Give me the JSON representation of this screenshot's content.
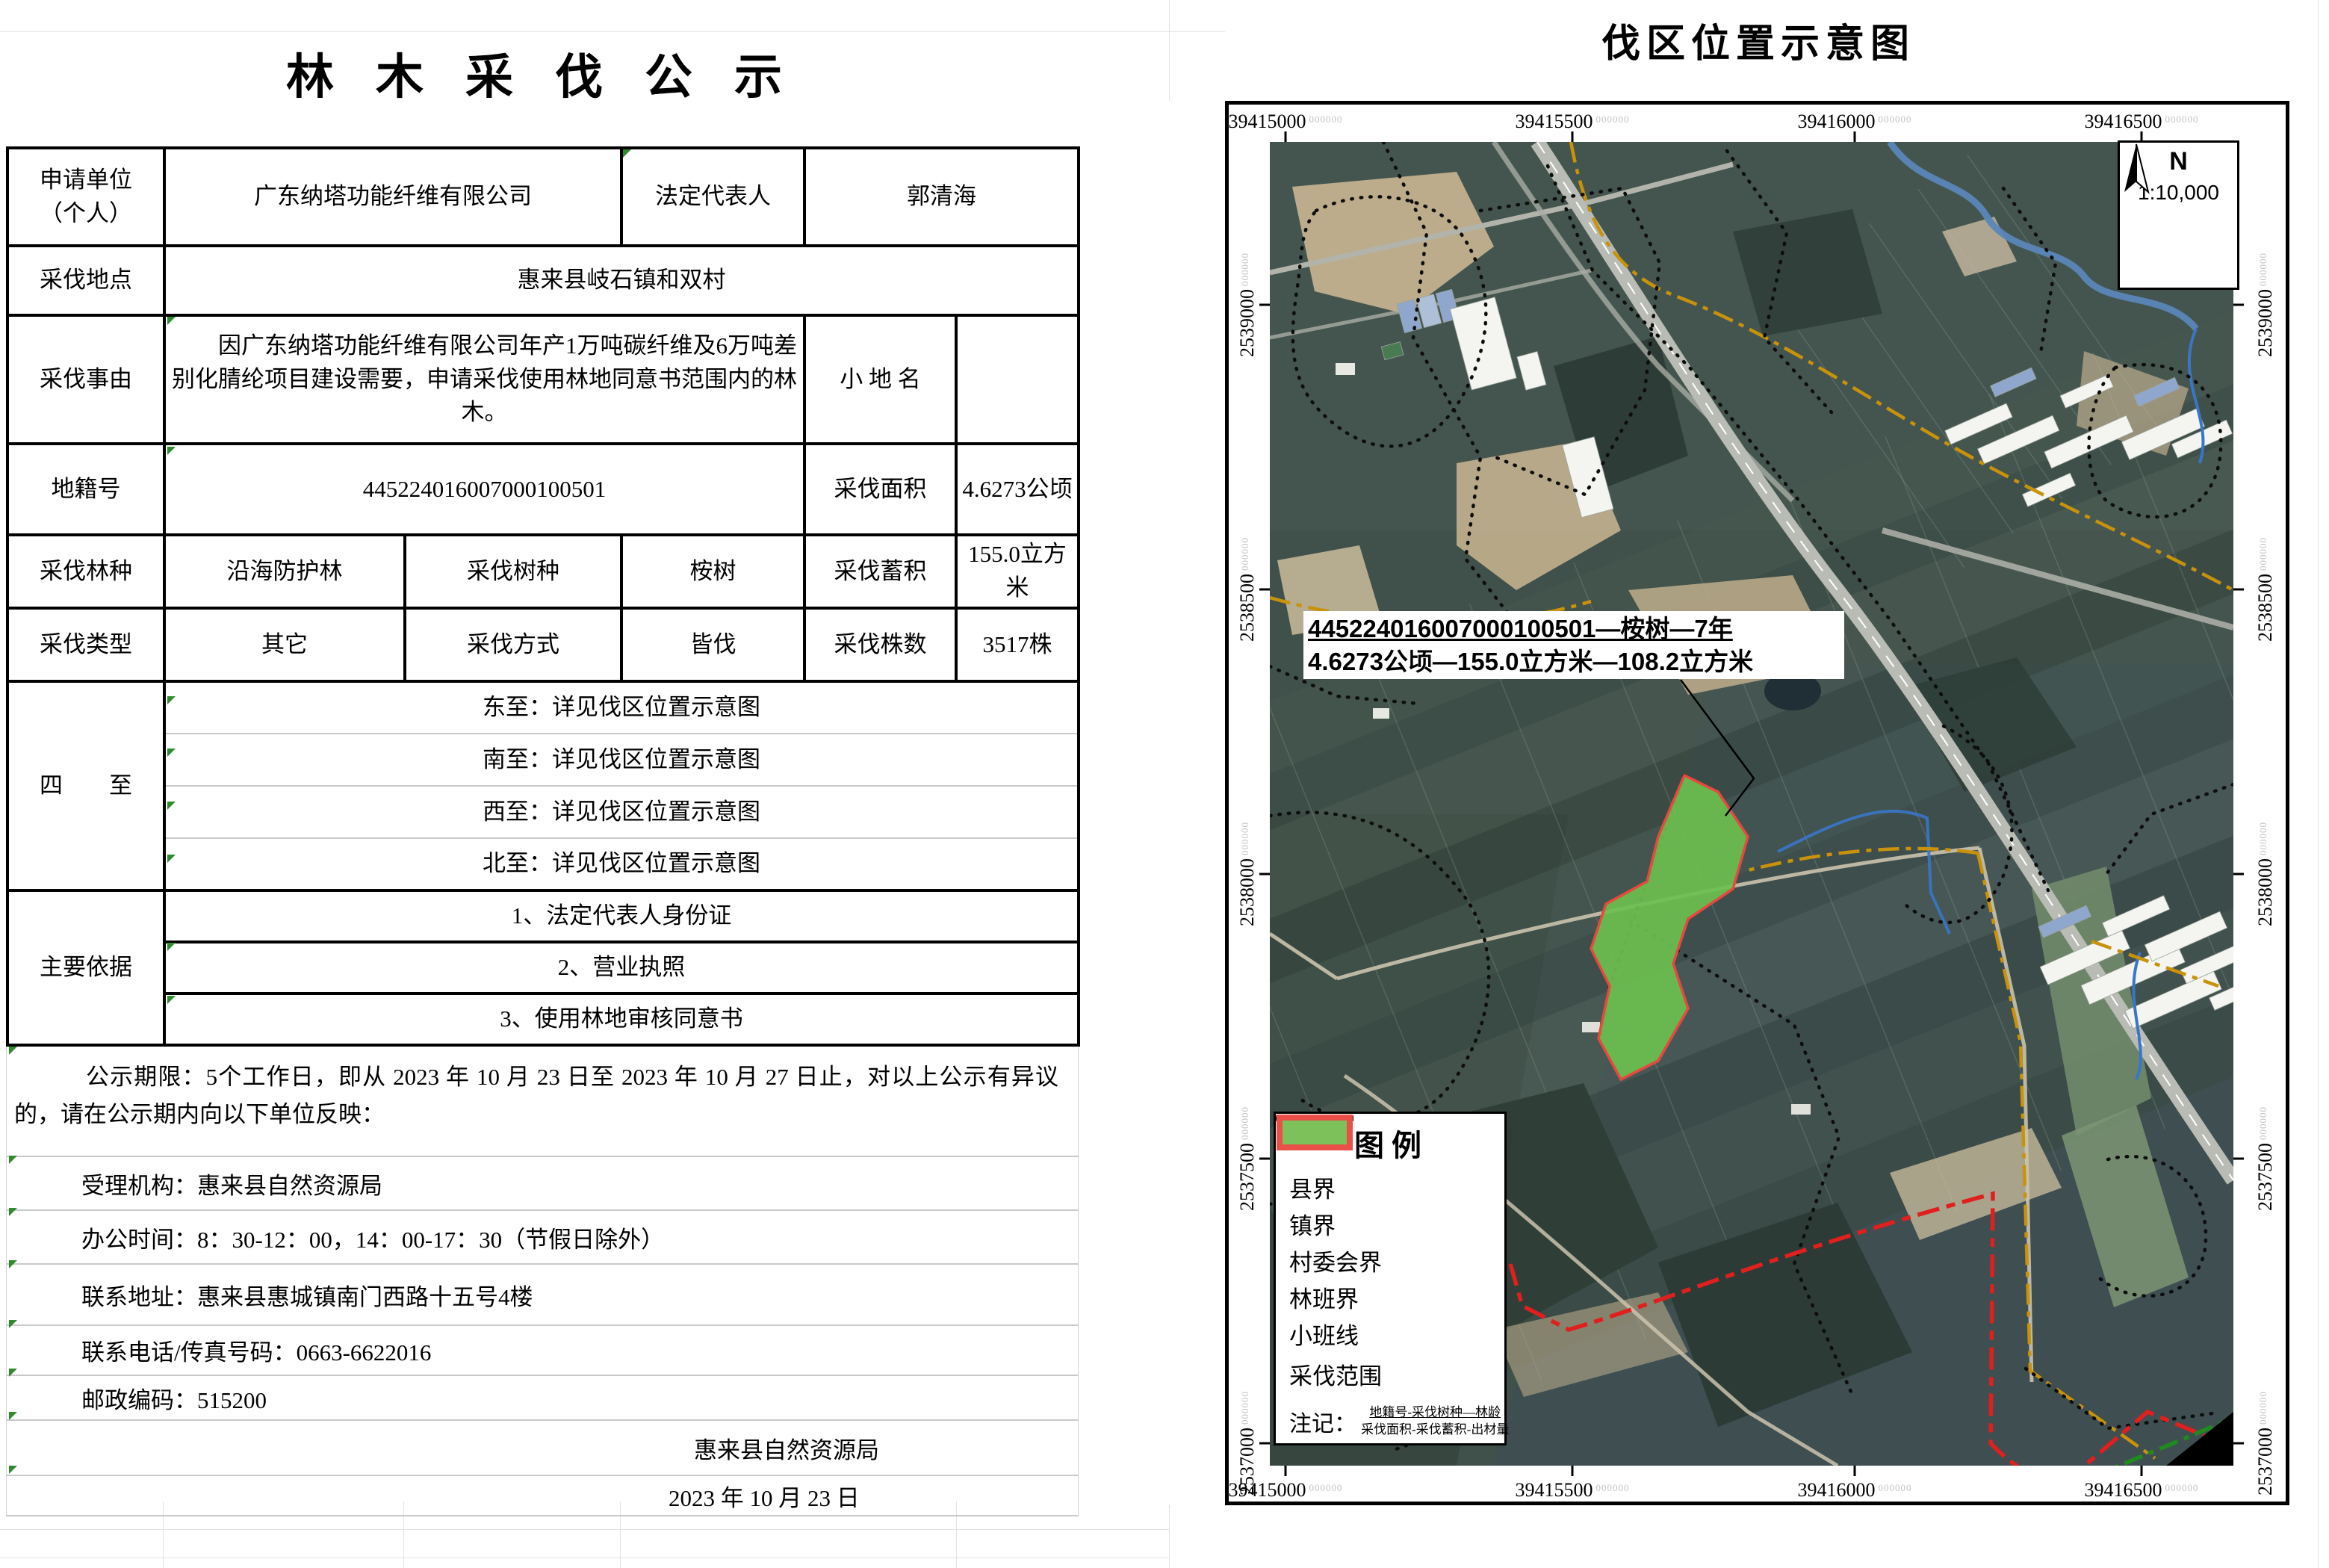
{
  "doc": {
    "title": "林 木 采 伐 公 示",
    "rows": {
      "applicant_label": "申请单位\n（个人）",
      "applicant_value": "广东纳塔功能纤维有限公司",
      "legal_rep_label": "法定代表人",
      "legal_rep_value": "郭清海",
      "location_label": "采伐地点",
      "location_value": "惠来县岐石镇和双村",
      "reason_label": "采伐事由",
      "reason_value": "因广东纳塔功能纤维有限公司年产1万吨碳纤维及6万吨差别化腈纶项目建设需要，申请采伐使用林地同意书范围内的林木。",
      "place_name_label": "小  地  名",
      "place_name_value": "",
      "cadastral_label": "地籍号",
      "cadastral_value": "445224016007000100501",
      "area_label": "采伐面积",
      "area_value": "4.6273公顷",
      "forest_type_label": "采伐林种",
      "forest_type_value": "沿海防护林",
      "species_label": "采伐树种",
      "species_value": "桉树",
      "volume_label": "采伐蓄积",
      "volume_value": "155.0立方米",
      "cut_type_label": "采伐类型",
      "cut_type_value": "其它",
      "method_label": "采伐方式",
      "method_value": "皆伐",
      "count_label": "采伐株数",
      "count_value": "3517株",
      "bounds_label": "四　　至",
      "bounds": [
        "东至：详见伐区位置示意图",
        "南至：详见伐区位置示意图",
        "西至：详见伐区位置示意图",
        "北至：详见伐区位置示意图"
      ],
      "basis_label": "主要依据",
      "basis": [
        "1、法定代表人身份证",
        "2、营业执照",
        "3、使用林地审核同意书"
      ]
    },
    "footer": {
      "period": "公示期限：5个工作日，即从 2023 年 10 月 23 日至 2023 年 10 月 27 日止，对以上公示有异议的，请在公示期内向以下单位反映：",
      "agency": "受理机构：惠来县自然资源局",
      "office_hours": "办公时间：8：30-12：00，14：00-17：30（节假日除外）",
      "address": "联系地址：惠来县惠城镇南门西路十五号4楼",
      "phone": "联系电话/传真号码：0663-6622016",
      "postcode": "邮政编码：515200",
      "signature": "惠来县自然资源局",
      "date": "2023 年 10 月 23 日"
    }
  },
  "map": {
    "title": "伐区位置示意图",
    "north_label": "N",
    "scale": "1:10,000",
    "label_suffix": "000000",
    "x_labels": [
      "39415000",
      "39415500",
      "39416000",
      "39416500"
    ],
    "y_labels": [
      "2539000",
      "2538500",
      "2538000",
      "2537500",
      "2537000"
    ],
    "parcel_label_line1": "445224016007000100501—桉树—7年",
    "parcel_label_line2": "4.6273公顷—155.0立方米—108.2立方米",
    "legend": {
      "title": "图例",
      "items": [
        {
          "label": "县界",
          "color": "#1e7d1e",
          "style": "dash-dot-dot"
        },
        {
          "label": "镇界",
          "color": "#e01f1f",
          "style": "dash"
        },
        {
          "label": "村委会界",
          "color": "#c8920a",
          "style": "dash-dot"
        },
        {
          "label": "林班界",
          "color": "#2b6cd4",
          "style": "solid"
        },
        {
          "label": "小班线",
          "color": "#111111",
          "style": "dotted"
        },
        {
          "label": "采伐范围",
          "fill": "#7dc15a",
          "stroke": "#e85048",
          "style": "polygon"
        }
      ],
      "note_label": "注记：",
      "note_line1": "地籍号-采伐树种—林龄",
      "note_line2": "采伐面积-采伐蓄积-出材量"
    }
  }
}
